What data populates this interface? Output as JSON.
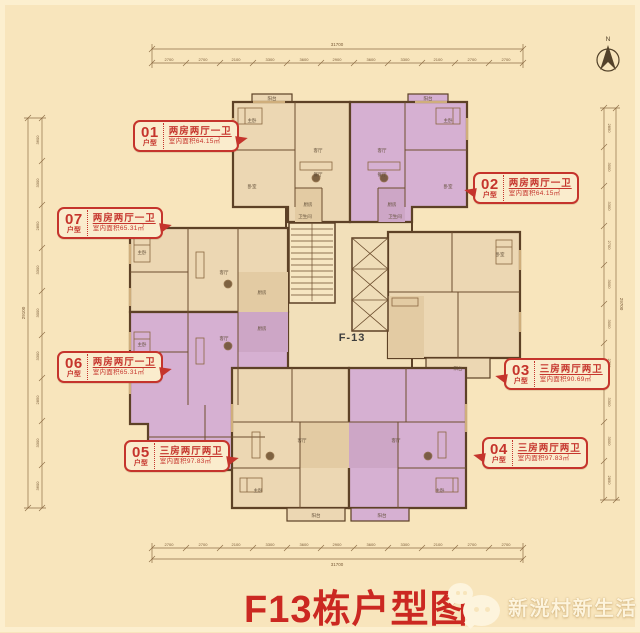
{
  "page": {
    "title": "F13栋户型图",
    "building_code": "F-13",
    "brand": "新洸村新生活",
    "compass_label": "N"
  },
  "units": [
    {
      "no": "01",
      "tag": "户型",
      "layout": "两房两厅一卫",
      "area": "室内面积64.15㎡"
    },
    {
      "no": "02",
      "tag": "户型",
      "layout": "两房两厅一卫",
      "area": "室内面积64.15㎡"
    },
    {
      "no": "03",
      "tag": "户型",
      "layout": "三房两厅两卫",
      "area": "室内面积90.69㎡"
    },
    {
      "no": "04",
      "tag": "户型",
      "layout": "三房两厅两卫",
      "area": "室内面积97.83㎡"
    },
    {
      "no": "05",
      "tag": "户型",
      "layout": "三房两厅两卫",
      "area": "室内面积97.83㎡"
    },
    {
      "no": "06",
      "tag": "户型",
      "layout": "两房两厅一卫",
      "area": "室内面积65.31㎡"
    },
    {
      "no": "07",
      "tag": "户型",
      "layout": "两房两厅一卫",
      "area": "室内面积65.31㎡"
    }
  ],
  "rooms": {
    "living": "客厅",
    "dining": "餐厅",
    "master": "主卧",
    "bed": "卧室",
    "kitchen": "厨房",
    "bath": "卫生间",
    "balcony": "阳台"
  },
  "dimensions": {
    "top": {
      "total": "31700",
      "segments": [
        "2700",
        "2700",
        "2100",
        "3300",
        "3600",
        "2900",
        "3600",
        "3300",
        "2100",
        "2700",
        "2700"
      ]
    },
    "bottom": {
      "total": "31700",
      "segments": [
        "2700",
        "2700",
        "2100",
        "3300",
        "3600",
        "2900",
        "3600",
        "3300",
        "2100",
        "2700",
        "2700"
      ]
    },
    "left": {
      "total": "29100",
      "segments": [
        "3600",
        "3300",
        "2850",
        "3300",
        "3000",
        "3300",
        "2850",
        "3300",
        "3600"
      ]
    },
    "right": {
      "total": "29700",
      "segments": [
        "2850",
        "3000",
        "3300",
        "2700",
        "3000",
        "3000",
        "2700",
        "3300",
        "3000",
        "2850"
      ]
    }
  },
  "colors": {
    "background": "#f8e5bc",
    "accent_red": "#c5342c",
    "title_red": "#cb2821",
    "wall": "#5d4126",
    "unit_beige": "#ecd7b3",
    "unit_purple": "#d6b0d2"
  }
}
